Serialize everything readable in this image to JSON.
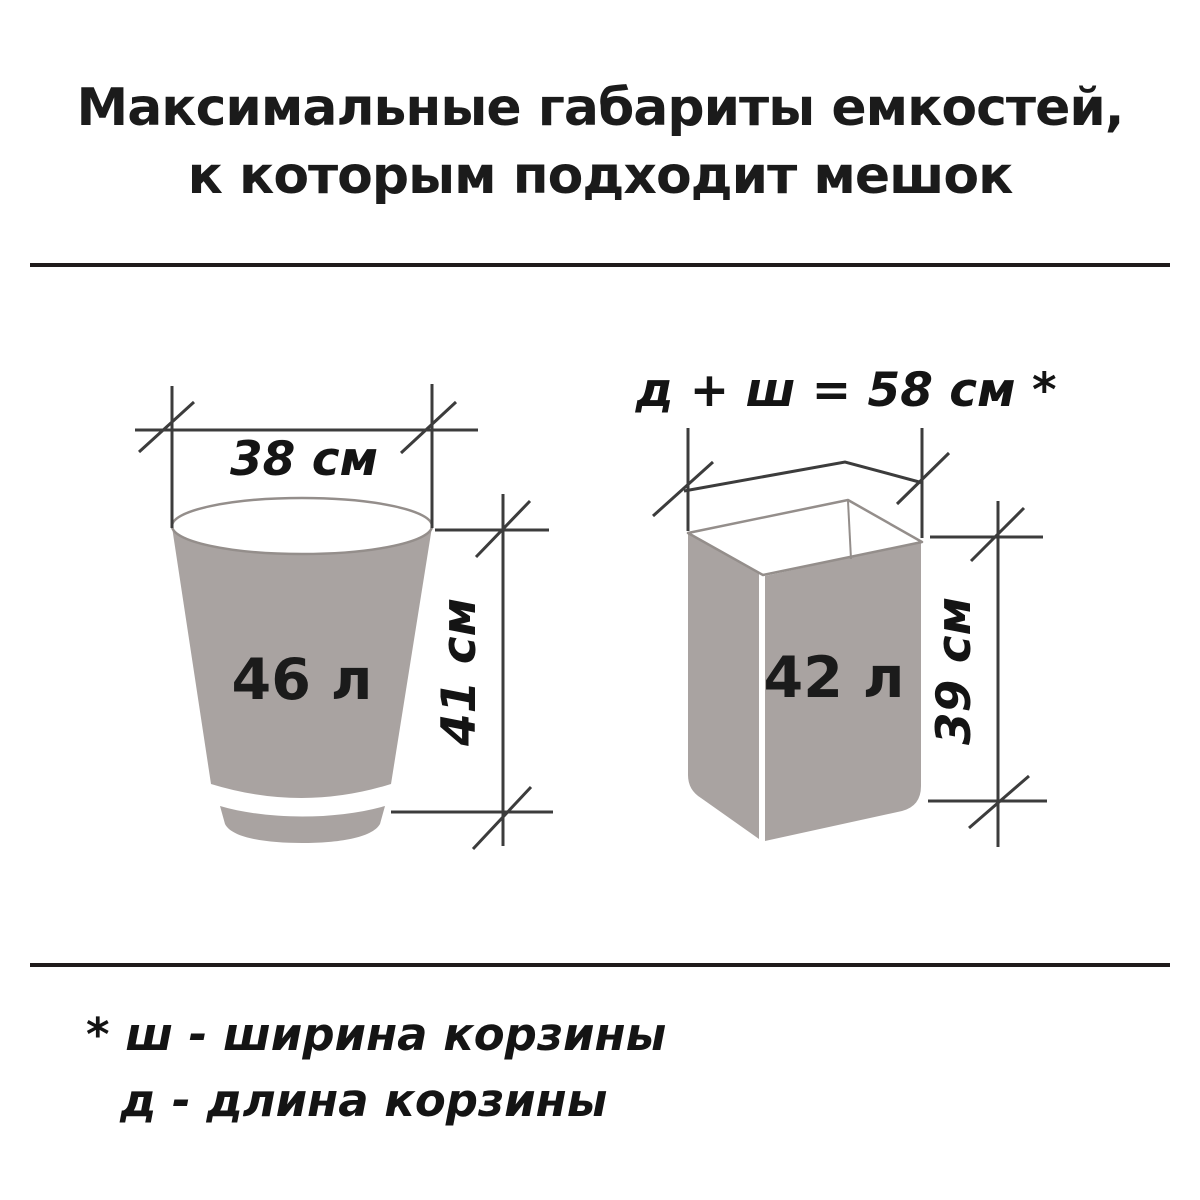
{
  "title": {
    "line1": "Максимальные габариты емкостей,",
    "line2": "к которым подходит мешок"
  },
  "round_bin": {
    "volume": "46 л",
    "width": "38 см",
    "height": "41 см"
  },
  "rect_bin": {
    "volume": "42 л",
    "top_formula": "д + ш = 58 см *",
    "height": "39 см"
  },
  "footnote": {
    "line1": "* ш - ширина корзины",
    "line2": "д  - длина корзины"
  },
  "colors": {
    "background": "#ffffff",
    "bin_fill": "#a9a3a1",
    "bin_outline": "#948e8b",
    "dimension_line": "#3c3c3c",
    "text": "#1b1b1b"
  }
}
